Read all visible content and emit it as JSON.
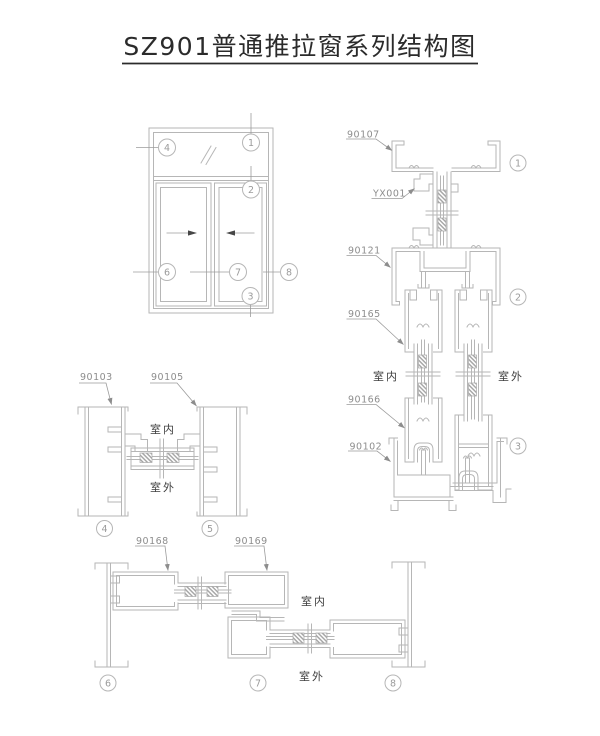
{
  "title": {
    "text": "SZ901普通推拉窗系列结构图"
  },
  "room_labels": {
    "indoor": "室内",
    "outdoor": "室外"
  },
  "part_labels": {
    "p90107": "90107",
    "yx001": "YX001",
    "p90121": "90121",
    "p90165": "90165",
    "p90166": "90166",
    "p90102": "90102",
    "p90103": "90103",
    "p90105": "90105",
    "p90168": "90168",
    "p90169": "90169"
  },
  "callouts": {
    "c1": "1",
    "c2": "2",
    "c3": "3",
    "c4": "4",
    "c5": "5",
    "c6": "6",
    "c7": "7",
    "c8": "8"
  },
  "colors": {
    "drawing_line": "#b6b6b6",
    "leader_line": "#9b9b9b",
    "part_label_text": "#8d8d8d",
    "room_label_text": "#3d3d3d",
    "title_text": "#2b2b2b",
    "slide_arrow": "#474747",
    "background": "#ffffff"
  }
}
